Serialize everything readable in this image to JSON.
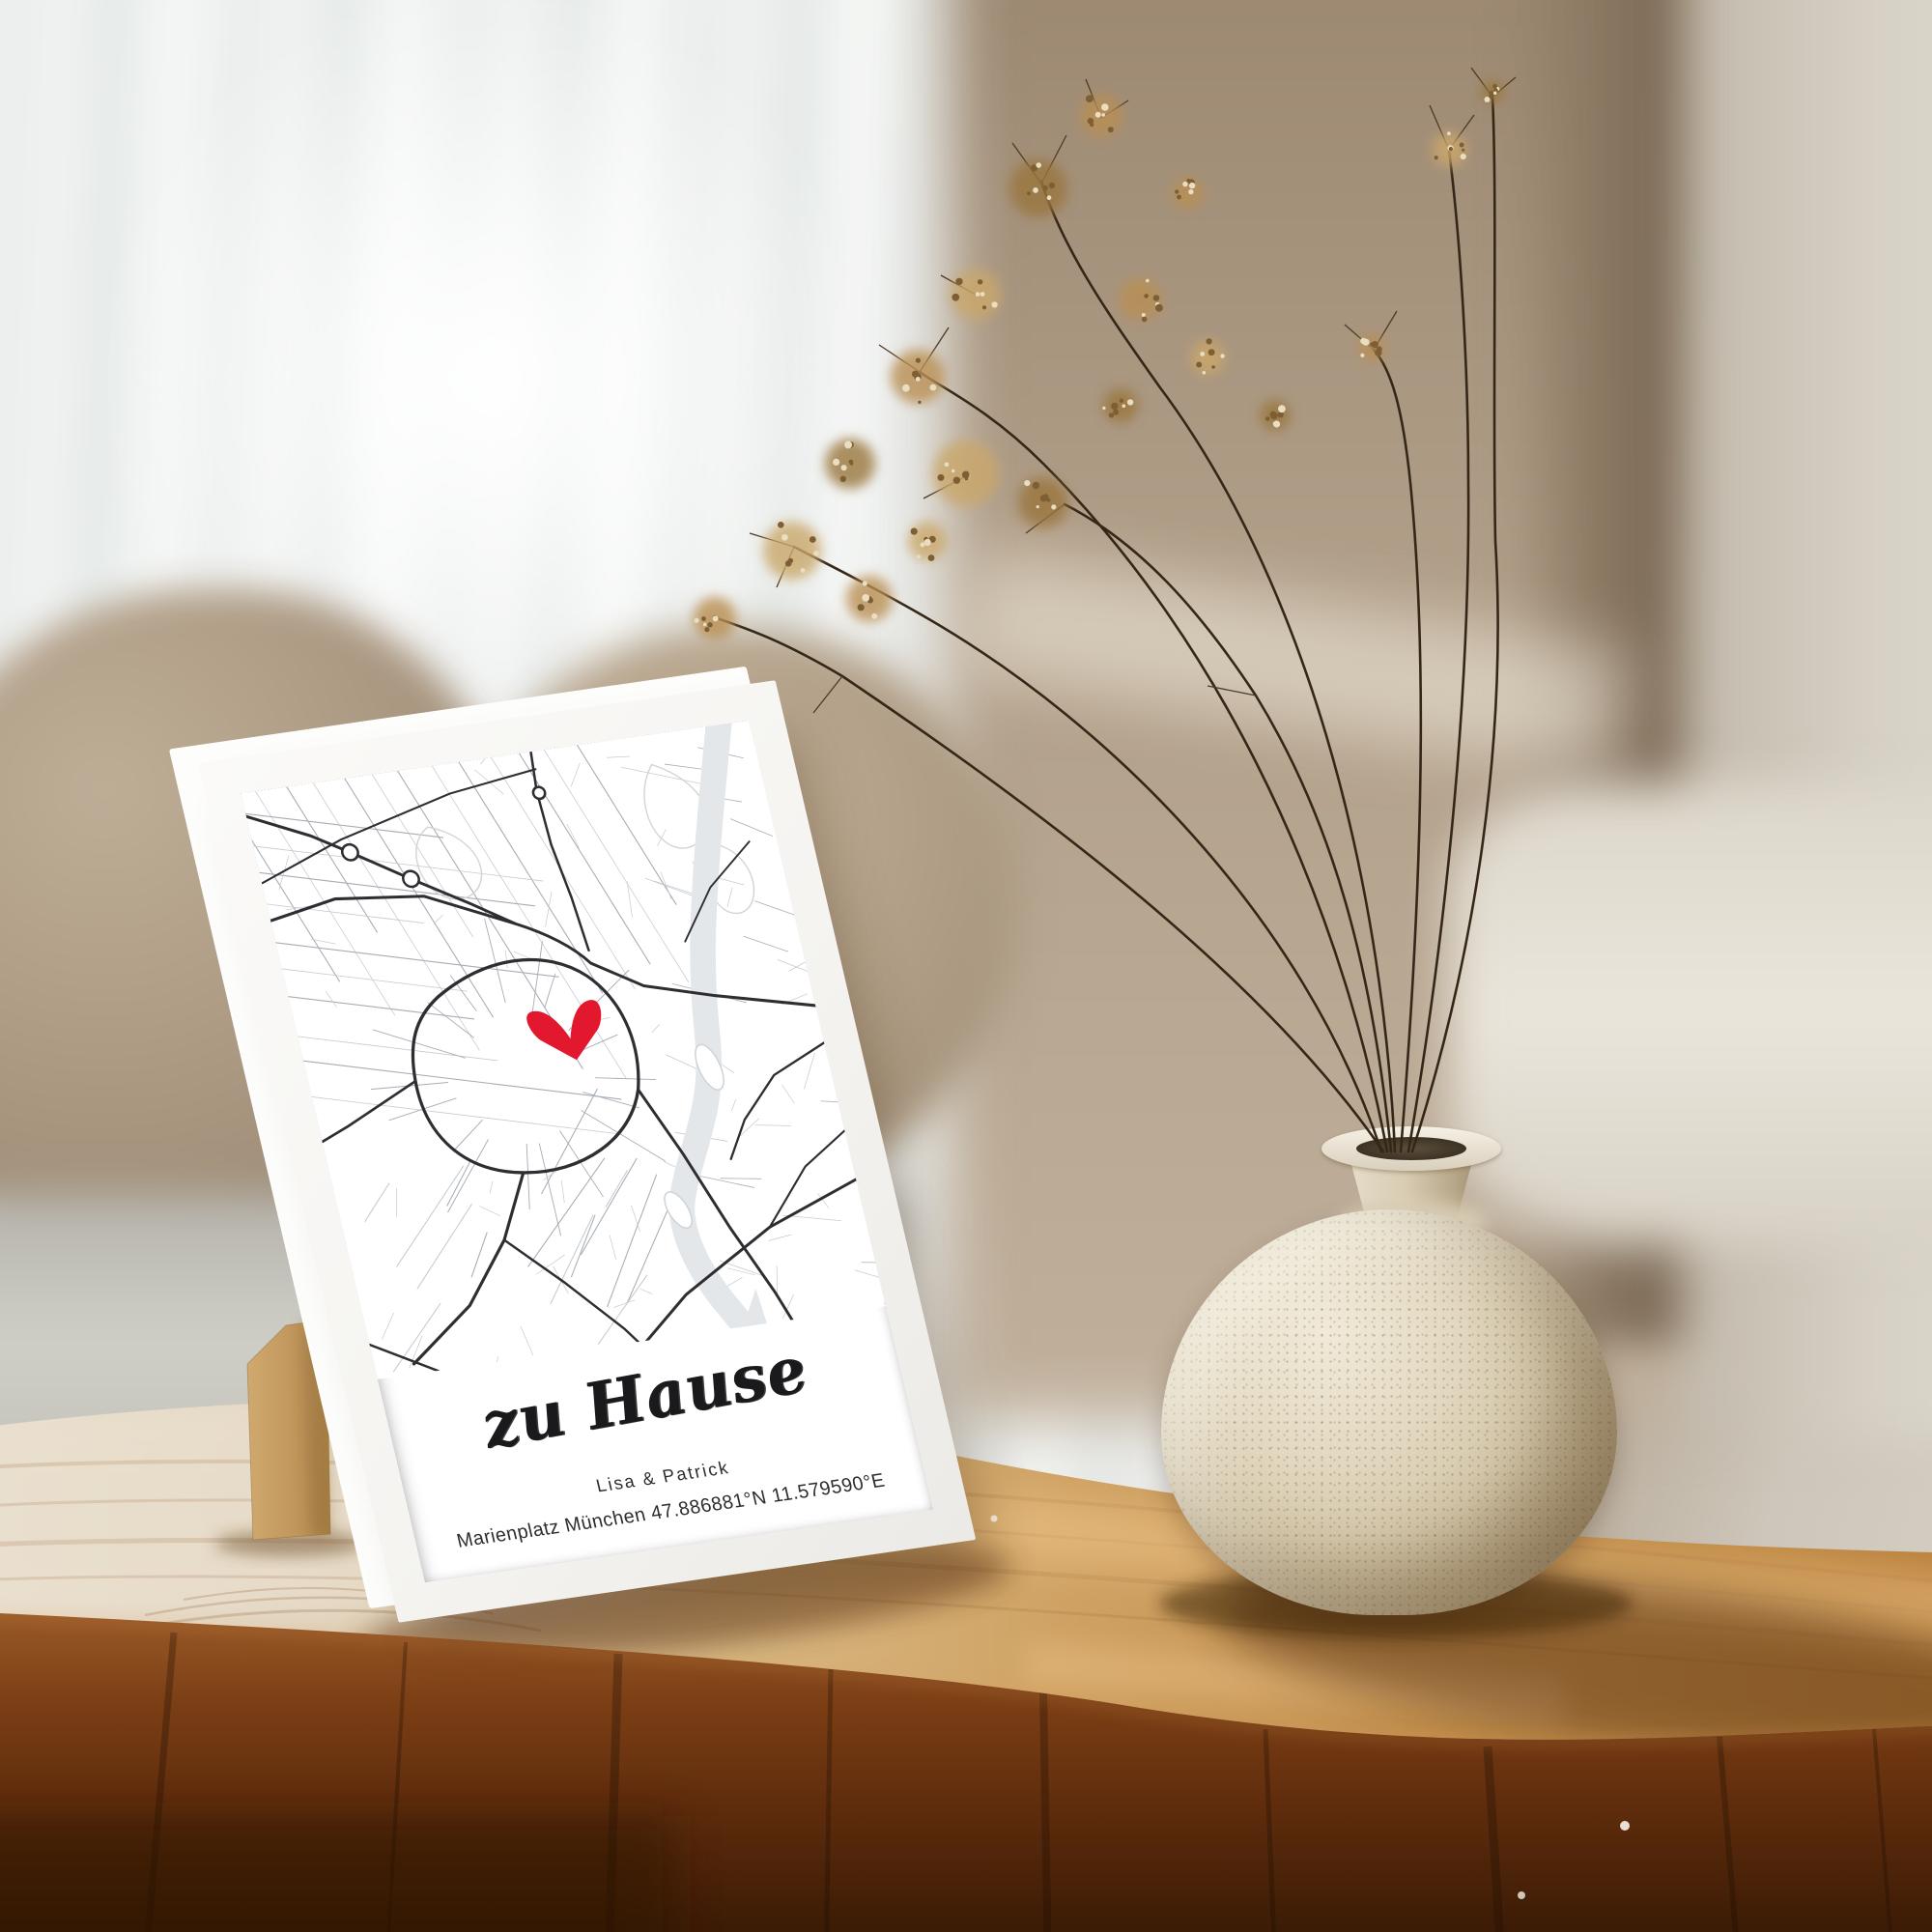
{
  "scene": {
    "description": "living room photo with framed personalized city-map print, wooden coffee table, ceramic vase with dried flowers",
    "print": {
      "title": "zu Hause",
      "names": "Lisa & Patrick",
      "coordinates": "Marienplatz München 47.886881°N 11.579590°E"
    },
    "colors": {
      "heart": "#e2182f",
      "frame": "#f5f4f2",
      "map_major_road": "#2e2e32",
      "map_minor_road": "#a7adb4",
      "river": "#e4e7ea",
      "table_top": "#cfa263",
      "table_front": "#5e2c0c",
      "stand_kraft": "#c09a5f",
      "vase_ceramic": "#ddd2bb",
      "flowers_gold": "#b98f52",
      "couch": "#b3a18c",
      "curtain": "#eef1f0"
    }
  }
}
